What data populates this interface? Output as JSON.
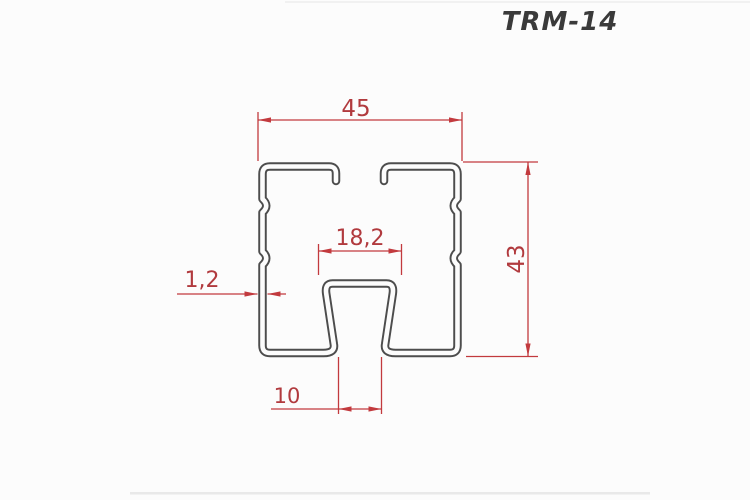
{
  "title": "TRM-14",
  "dimensions": {
    "overall_width": {
      "label": "45"
    },
    "overall_height": {
      "label": "43"
    },
    "channel_top_width": {
      "label": "18,2"
    },
    "wall_thickness": {
      "label": "1,2"
    },
    "slot_opening": {
      "label": "10"
    }
  },
  "colors": {
    "profile_line": "#4d4d4d",
    "dimension_red": "#c23a3e",
    "background": "#fcfcfc"
  }
}
